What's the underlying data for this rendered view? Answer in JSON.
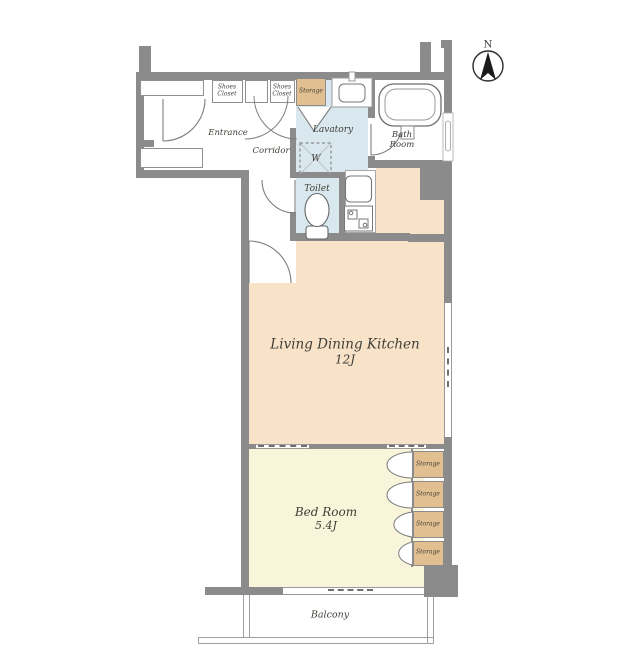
{
  "colors": {
    "wall": "#8b8b8b",
    "ldk_floor": "#f8e3c8",
    "bedroom_floor": "#f8f5da",
    "wet_area_floor": "#d9e8ef",
    "storage_fill": "#e2bf90",
    "fixture_stroke": "#777777",
    "text": "#3f3f38"
  },
  "compass": {
    "label": "N"
  },
  "rooms": {
    "ldk": {
      "name": "Living Dining Kitchen",
      "size": "12J"
    },
    "bedroom": {
      "name": "Bed Room",
      "size": "5.4J"
    },
    "lavatory": {
      "name": "Lavatory"
    },
    "bathroom": {
      "line1": "Bath",
      "line2": "Room"
    },
    "toilet": {
      "name": "Toilet"
    },
    "corridor": {
      "name": "Corridor"
    },
    "entrance": {
      "name": "Entrance"
    },
    "balcony": {
      "name": "Balcony"
    }
  },
  "storage": {
    "shoes_closet_left": {
      "line1": "Shoes",
      "line2": "Closet"
    },
    "shoes_closet_right": {
      "line1": "Shoes",
      "line2": "Closet"
    },
    "entry_storage": "Storage",
    "bedroom_storage_units": [
      "Storage",
      "Storage",
      "Storage",
      "Storage"
    ]
  },
  "appliances": {
    "washing_machine": "W"
  },
  "icons": {
    "compass": "north-arrow-in-circle",
    "bathtub": "bathtub-outline",
    "washbasin": "basin-outline",
    "kitchen_sink": "sink-square",
    "stove": "two-burner-stove",
    "toilet": "toilet-bowl",
    "washer_space": "dashed-square-with-cross"
  }
}
